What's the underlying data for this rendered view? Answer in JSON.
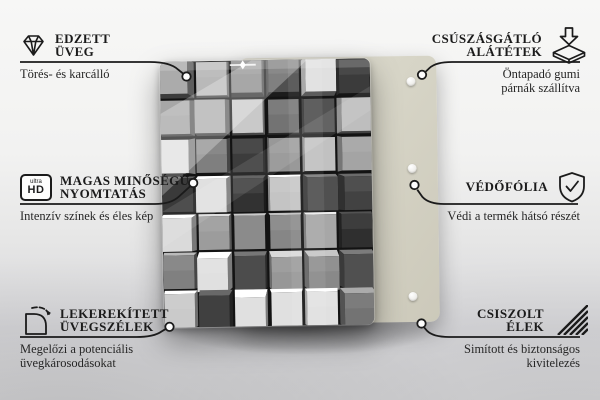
{
  "colors": {
    "line": "#1b1b1b",
    "back_panel": "#d7d5c7",
    "background_top": "#f7f7f6",
    "background_bottom": "#d6d6d9"
  },
  "hd_badge": {
    "top": "ultra",
    "main": "HD"
  },
  "features": [
    {
      "id": "tempered-glass",
      "icon": "diamond-icon",
      "title_lines": [
        "EDZETT",
        "ÜVEG"
      ],
      "subtitle_lines": [
        "Törés- és karcálló"
      ]
    },
    {
      "id": "anti-slip-pads",
      "icon": "pads-icon",
      "title_lines": [
        "CSÚSZÁSGÁTLÓ",
        "ALÁTÉTEK"
      ],
      "subtitle_lines": [
        "Öntapadó gumi",
        "párnák szállítva"
      ]
    },
    {
      "id": "high-quality-print",
      "icon": "ultra-hd-icon",
      "title_lines": [
        "MAGAS MINŐSÉGŰ",
        "NYOMTATÁS"
      ],
      "subtitle_lines": [
        "Intenzív színek és éles kép"
      ]
    },
    {
      "id": "protective-film",
      "icon": "shield-check-icon",
      "title_lines": [
        "VÉDŐFÓLIA"
      ],
      "subtitle_lines": [
        "Védi a termék hátsó részét"
      ]
    },
    {
      "id": "rounded-edges",
      "icon": "rounded-corner-icon",
      "title_lines": [
        "LEKEREKÍTETT",
        "ÜVEGSZÉLEK"
      ],
      "subtitle_lines": [
        "Megelőzi a potenciális",
        "üvegkárosodásokat"
      ]
    },
    {
      "id": "polished-edges",
      "icon": "hatch-icon",
      "title_lines": [
        "CSISZOLT",
        "ÉLEK"
      ],
      "subtitle_lines": [
        "Simított és biztonságos",
        "kivitelezés"
      ]
    }
  ]
}
